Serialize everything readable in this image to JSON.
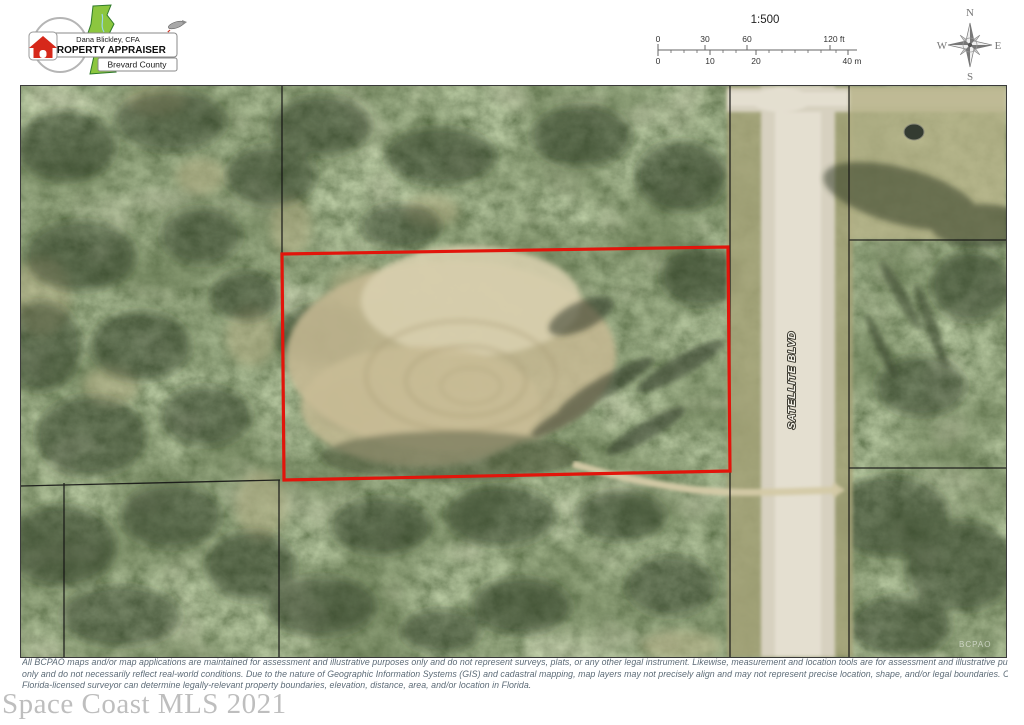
{
  "header": {
    "logo": {
      "owner": "Dana Blickley, CFA",
      "title": "PROPERTY APPRAISER",
      "county": "Brevard County"
    },
    "scale": {
      "ratio": "1:500",
      "ft_labels": [
        "0",
        "30",
        "60",
        "120 ft"
      ],
      "m_labels": [
        "0",
        "10",
        "20",
        "40 m"
      ]
    },
    "compass": {
      "n": "N",
      "e": "E",
      "s": "S",
      "w": "W"
    }
  },
  "map": {
    "road_label": "SATELLITE BLVD",
    "corner_watermark": "BCPAO",
    "parcel_outline_color": "#e2150b",
    "boundary_line_color": "#151515"
  },
  "footer": {
    "disclaimer_lines": [
      "All BCPAO maps and/or map applications are maintained for assessment and illustrative purposes only and do not represent surveys, plats, or any other legal instrument. Likewise, measurement and location tools are for assessment and illustrative purposes",
      "only and do not necessarily reflect real-world conditions. Due to the nature of Geographic Information Systems (GIS) and cadastral mapping, map layers may not precisely align and may not represent precise location, shape, and/or legal boundaries. Only a",
      "Florida-licensed surveyor can determine legally-relevant property boundaries, elevation, distance, area, and/or location in Florida."
    ],
    "watermark": "Space Coast MLS 2021"
  }
}
